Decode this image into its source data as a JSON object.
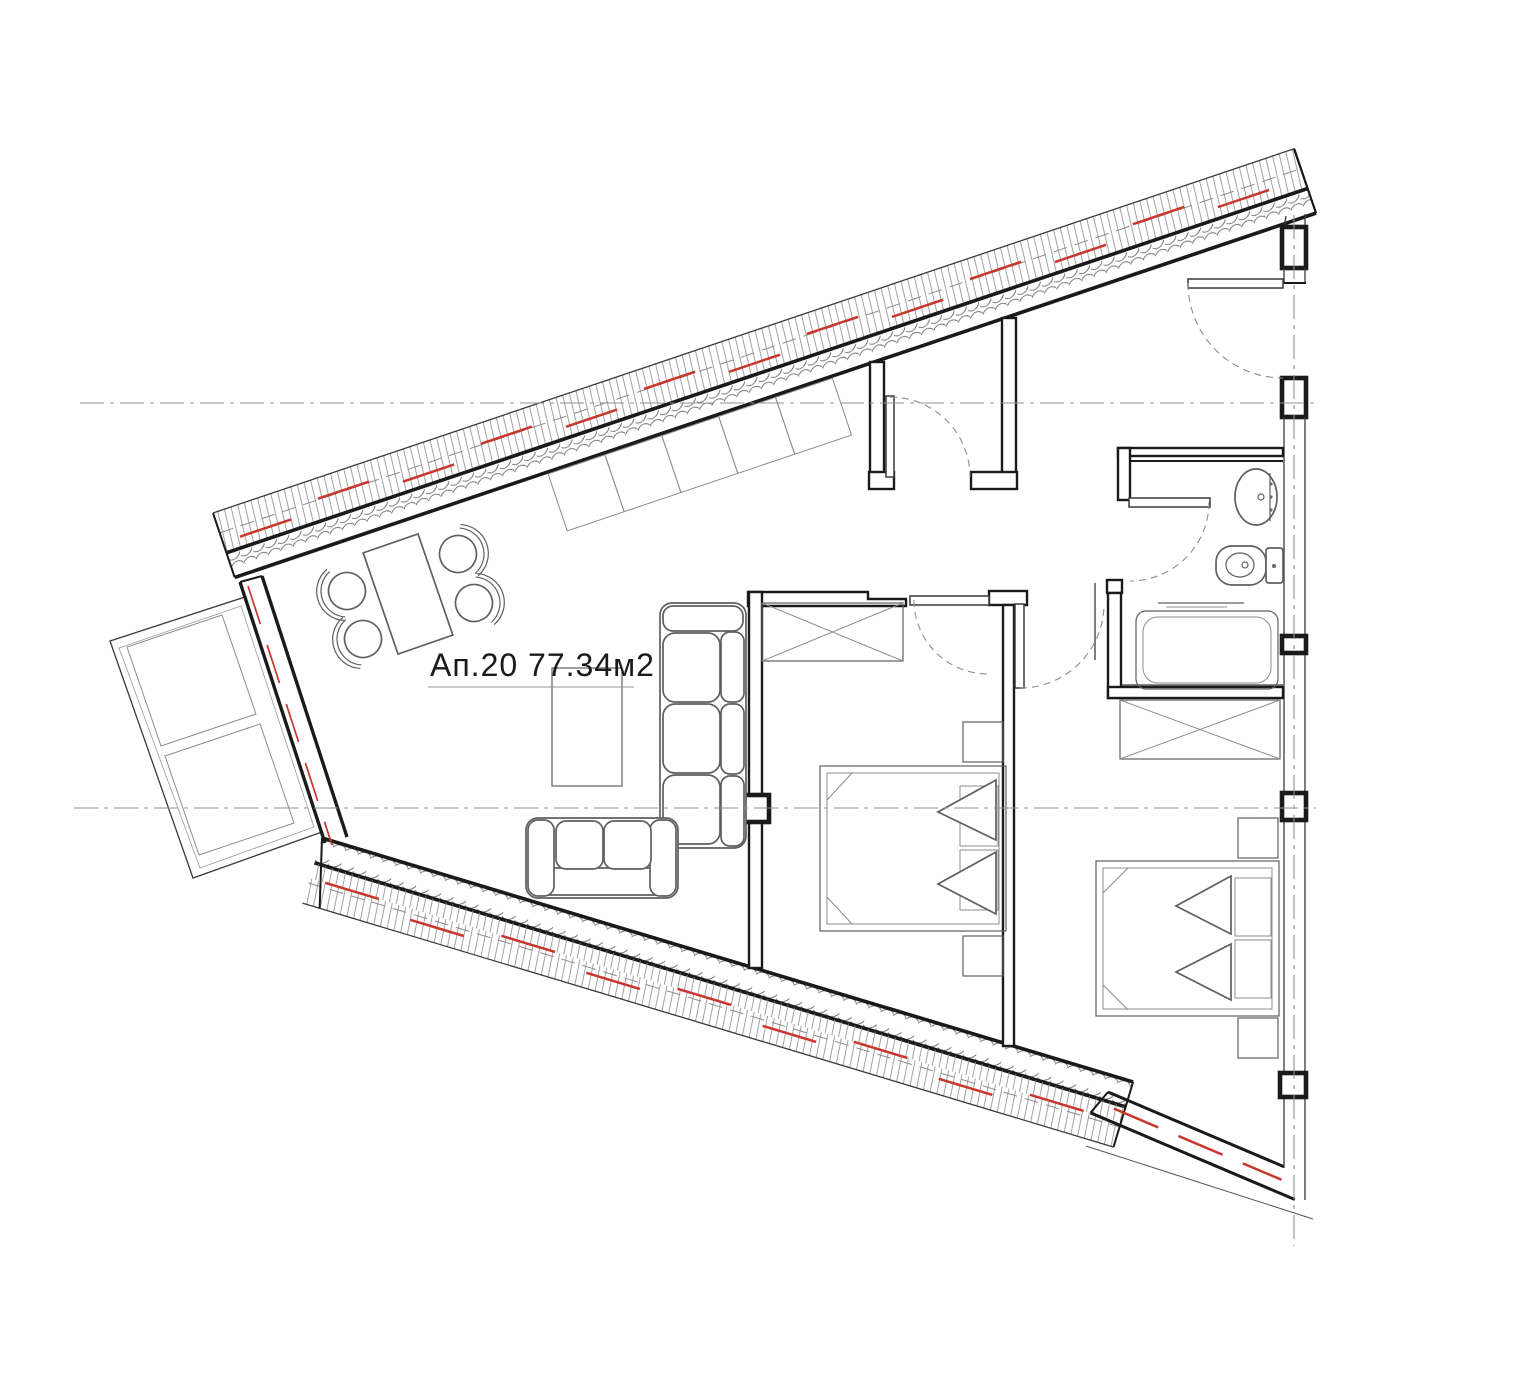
{
  "plan": {
    "label": "Ап.20 77.34м2",
    "apartment_no": "Ап.20",
    "area": "77.34м2",
    "colors": {
      "wall": "#1a1a1a",
      "mid": "#3a3a3a",
      "furn": "#5f5f5f",
      "light": "#8c8c8c",
      "axis": "#909090",
      "red": "#c9362c",
      "bg": "#ffffff"
    }
  }
}
